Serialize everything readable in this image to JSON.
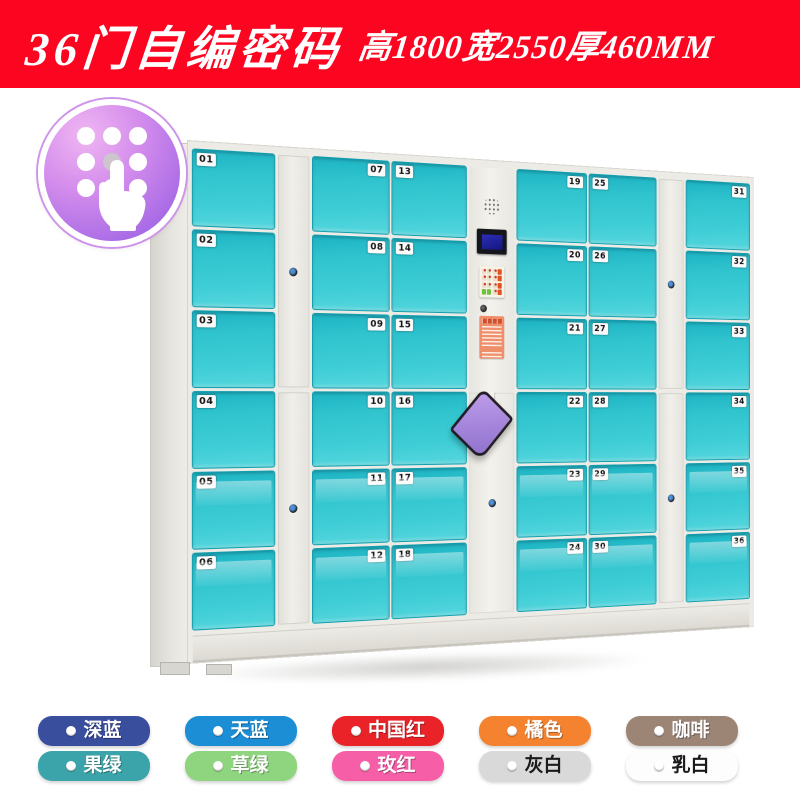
{
  "banner": {
    "title": "36门自编密码",
    "dims": "高1800宽2550厚460MM",
    "bg_color": "#fb0520"
  },
  "badge": {
    "icon": "keypad-touch-icon",
    "gradient_top": "#f0b6f2",
    "gradient_bottom": "#9c5fe0"
  },
  "locker": {
    "door_color": "#35c6d2",
    "frame_color": "#ecebe6",
    "screen_color": "#1a1c96",
    "sticker_color": "#ef8f6a",
    "bag_color": "#a384da",
    "columns": [
      {
        "type": "doors",
        "label_side": "left",
        "numbers": [
          "01",
          "02",
          "03",
          "04",
          "05",
          "06"
        ]
      },
      {
        "type": "stile"
      },
      {
        "type": "doors",
        "label_side": "right",
        "numbers": [
          "07",
          "08",
          "09",
          "10",
          "11",
          "12"
        ]
      },
      {
        "type": "doors",
        "label_side": "left",
        "numbers": [
          "13",
          "14",
          "15",
          "16",
          "17",
          "18"
        ]
      },
      {
        "type": "control"
      },
      {
        "type": "doors",
        "label_side": "right",
        "numbers": [
          "19",
          "20",
          "21",
          "22",
          "23",
          "24"
        ]
      },
      {
        "type": "doors",
        "label_side": "left",
        "numbers": [
          "25",
          "26",
          "27",
          "28",
          "29",
          "30"
        ]
      },
      {
        "type": "stile"
      },
      {
        "type": "doors",
        "label_side": "right",
        "numbers": [
          "31",
          "32",
          "33",
          "34",
          "35",
          "36"
        ]
      }
    ]
  },
  "swatches": {
    "rows": [
      [
        {
          "label": "深蓝",
          "color": "#3a4e9e",
          "text_color": "#ffffff"
        },
        {
          "label": "天蓝",
          "color": "#1b8ed6",
          "text_color": "#ffffff"
        },
        {
          "label": "中国红",
          "color": "#ea2328",
          "text_color": "#ffffff"
        },
        {
          "label": "橘色",
          "color": "#f5822e",
          "text_color": "#ffffff"
        },
        {
          "label": "咖啡",
          "color": "#9d8576",
          "text_color": "#ffffff"
        }
      ],
      [
        {
          "label": "果绿",
          "color": "#3ba4aa",
          "text_color": "#ffffff"
        },
        {
          "label": "草绿",
          "color": "#8fd47f",
          "text_color": "#ffffff"
        },
        {
          "label": "玫红",
          "color": "#f65fa8",
          "text_color": "#ffffff"
        },
        {
          "label": "灰白",
          "color": "#d9d9d9",
          "text_color": "#1a1a1a"
        },
        {
          "label": "乳白",
          "color": "#fdfdfd",
          "text_color": "#1a1a1a"
        }
      ]
    ]
  }
}
